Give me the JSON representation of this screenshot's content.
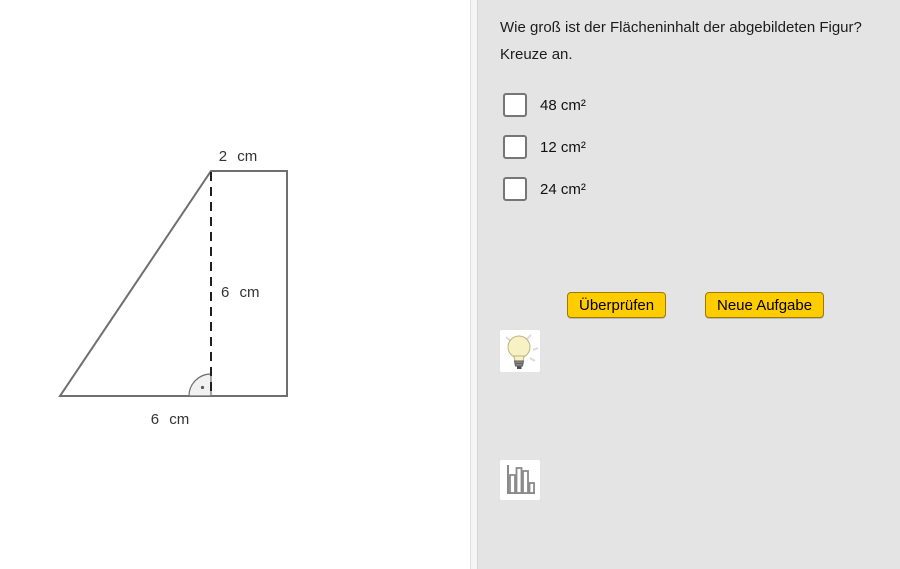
{
  "figure": {
    "top_label": "2 cm",
    "height_label": "6 cm",
    "base_label": "6 cm"
  },
  "question": {
    "line1": "Wie groß ist der Flächeninhalt der abgebildeten Figur?",
    "line2": "Kreuze an."
  },
  "options": [
    {
      "label": "48 cm²",
      "checked": false
    },
    {
      "label": "12 cm²",
      "checked": false
    },
    {
      "label": "24 cm²",
      "checked": false
    }
  ],
  "buttons": {
    "check": "Überprüfen",
    "new_task": "Neue Aufgabe"
  },
  "icons": {
    "hint": "lightbulb-icon",
    "stats": "bar-chart-icon"
  },
  "colors": {
    "panel_bg": "#e4e4e4",
    "canvas_bg": "#ffffff",
    "button_bg": "#ffcc00",
    "button_border": "#9a7d00",
    "figure_stroke": "#6f6f6f",
    "dashed_stroke": "#1f1f1f"
  }
}
